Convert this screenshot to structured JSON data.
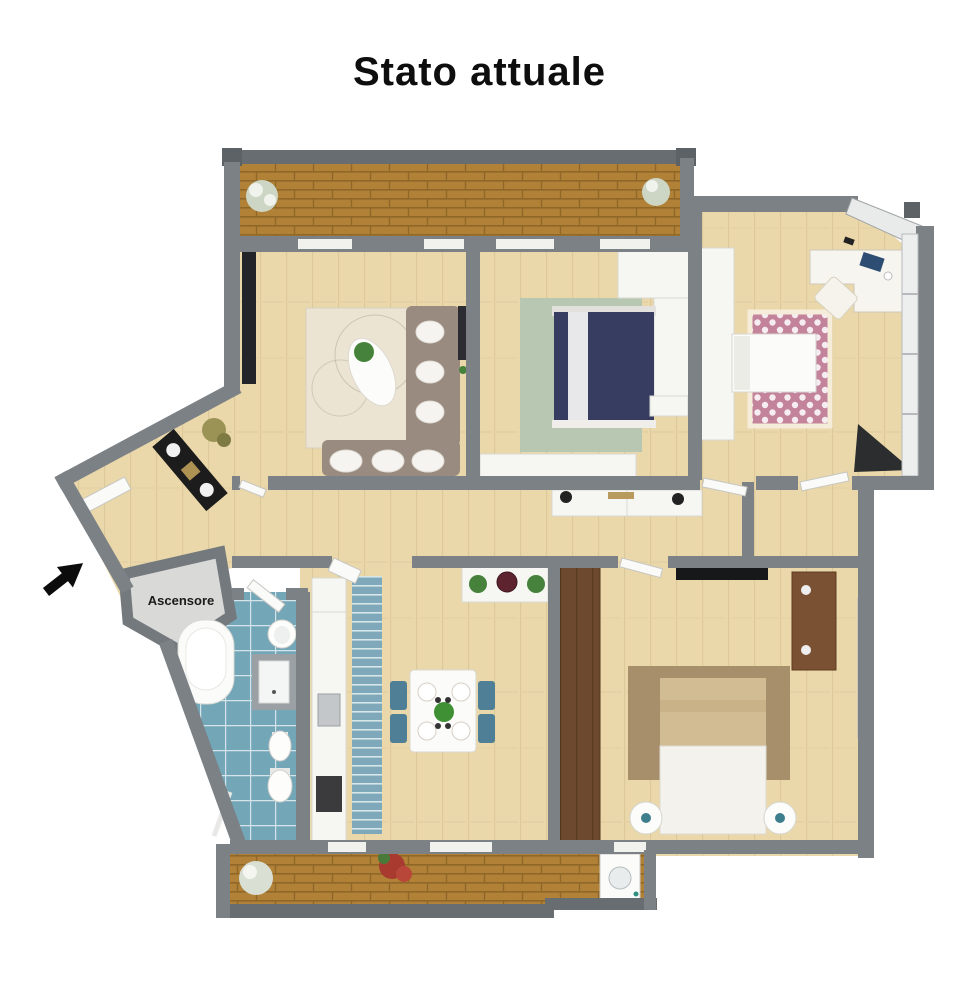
{
  "title": "Stato attuale",
  "labels": {
    "elevator": "Ascensore"
  },
  "colors": {
    "wall": "#7c8186",
    "railing": "#686d72",
    "wood": "#ead8ab",
    "brick": "#b28138",
    "tile": "#73a6b7",
    "sofa": "#998b7f",
    "bed_navy": "#373d60",
    "rug_sage": "#b7c7b1",
    "rug_pink": "#c2839b",
    "rug_cream": "#ece4d2",
    "rug_brown": "#a88f6c",
    "runner_blue": "#7fa9ba",
    "chair_blue": "#4f7f96",
    "wardrobe_brown": "#6d4a2f",
    "plant_green": "#46823b",
    "bed_tan": "#d2bc94"
  }
}
